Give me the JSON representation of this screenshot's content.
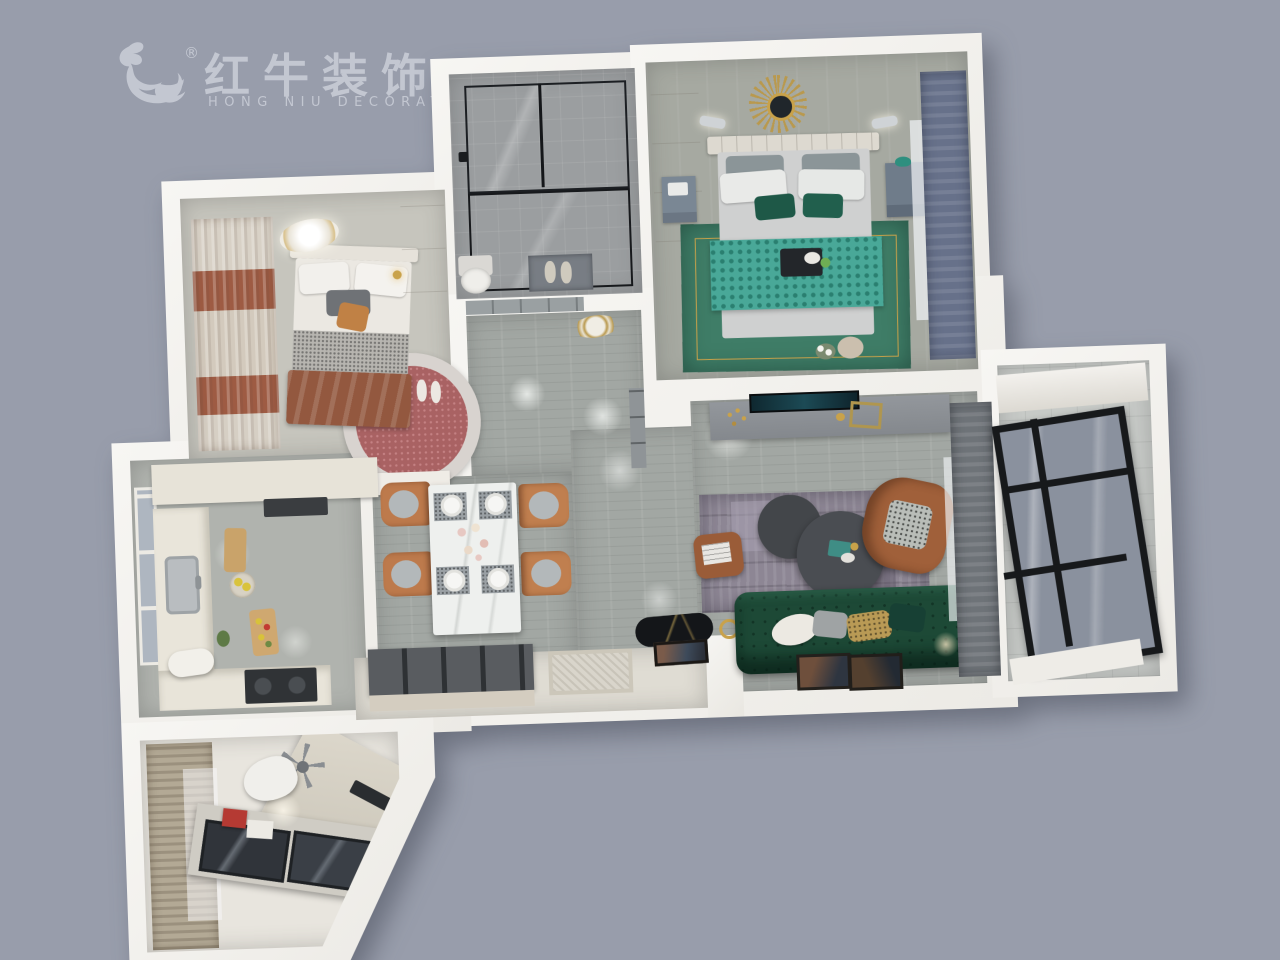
{
  "watermark": {
    "icon": "hongniu-bull-icon",
    "registered": "®",
    "brand": "红牛装饰",
    "subtitle": "HONG NIU DECORATION",
    "color": "#c7cbd5"
  },
  "scene": {
    "description": "3D top-down dollhouse render of a two-bedroom apartment",
    "background_color": "#989dab",
    "wall_color": "#f3f2ef",
    "rooms": [
      {
        "name": "secondary-bedroom",
        "floor": "#c6c5bd",
        "accents": [
          "#9e5b43",
          "#a96263",
          "#c08145"
        ]
      },
      {
        "name": "bathroom",
        "floor": "#9b9ea0",
        "accents": [
          "#2e3135",
          "#787d84"
        ]
      },
      {
        "name": "master-bedroom",
        "floor": "#a6a9a1",
        "accents": [
          "#49a898",
          "#3f7d67",
          "#67718a",
          "#c9a24a"
        ]
      },
      {
        "name": "hallway",
        "floor": "#a2a7a3",
        "accents": [
          "#b9994e"
        ]
      },
      {
        "name": "dining-area",
        "floor": "#a2a7a3",
        "accents": [
          "#bd7a4c",
          "#eef0ee"
        ]
      },
      {
        "name": "kitchen",
        "floor": "#b0b3ae",
        "accents": [
          "#e9e5da",
          "#303336",
          "#c9a36a"
        ]
      },
      {
        "name": "living-room",
        "floor": "#9aa09c",
        "accents": [
          "#1d4936",
          "#a0603a",
          "#8d8694",
          "#43464a"
        ]
      },
      {
        "name": "balcony",
        "floor": "#c7cac7",
        "accents": [
          "#17191b"
        ]
      },
      {
        "name": "study",
        "floor": "#e8e5de",
        "accents": [
          "#b3a995",
          "#b53a33"
        ]
      },
      {
        "name": "entry",
        "floor": "#dfdcd3",
        "accents": [
          "#595c60",
          "#141619"
        ]
      }
    ]
  }
}
